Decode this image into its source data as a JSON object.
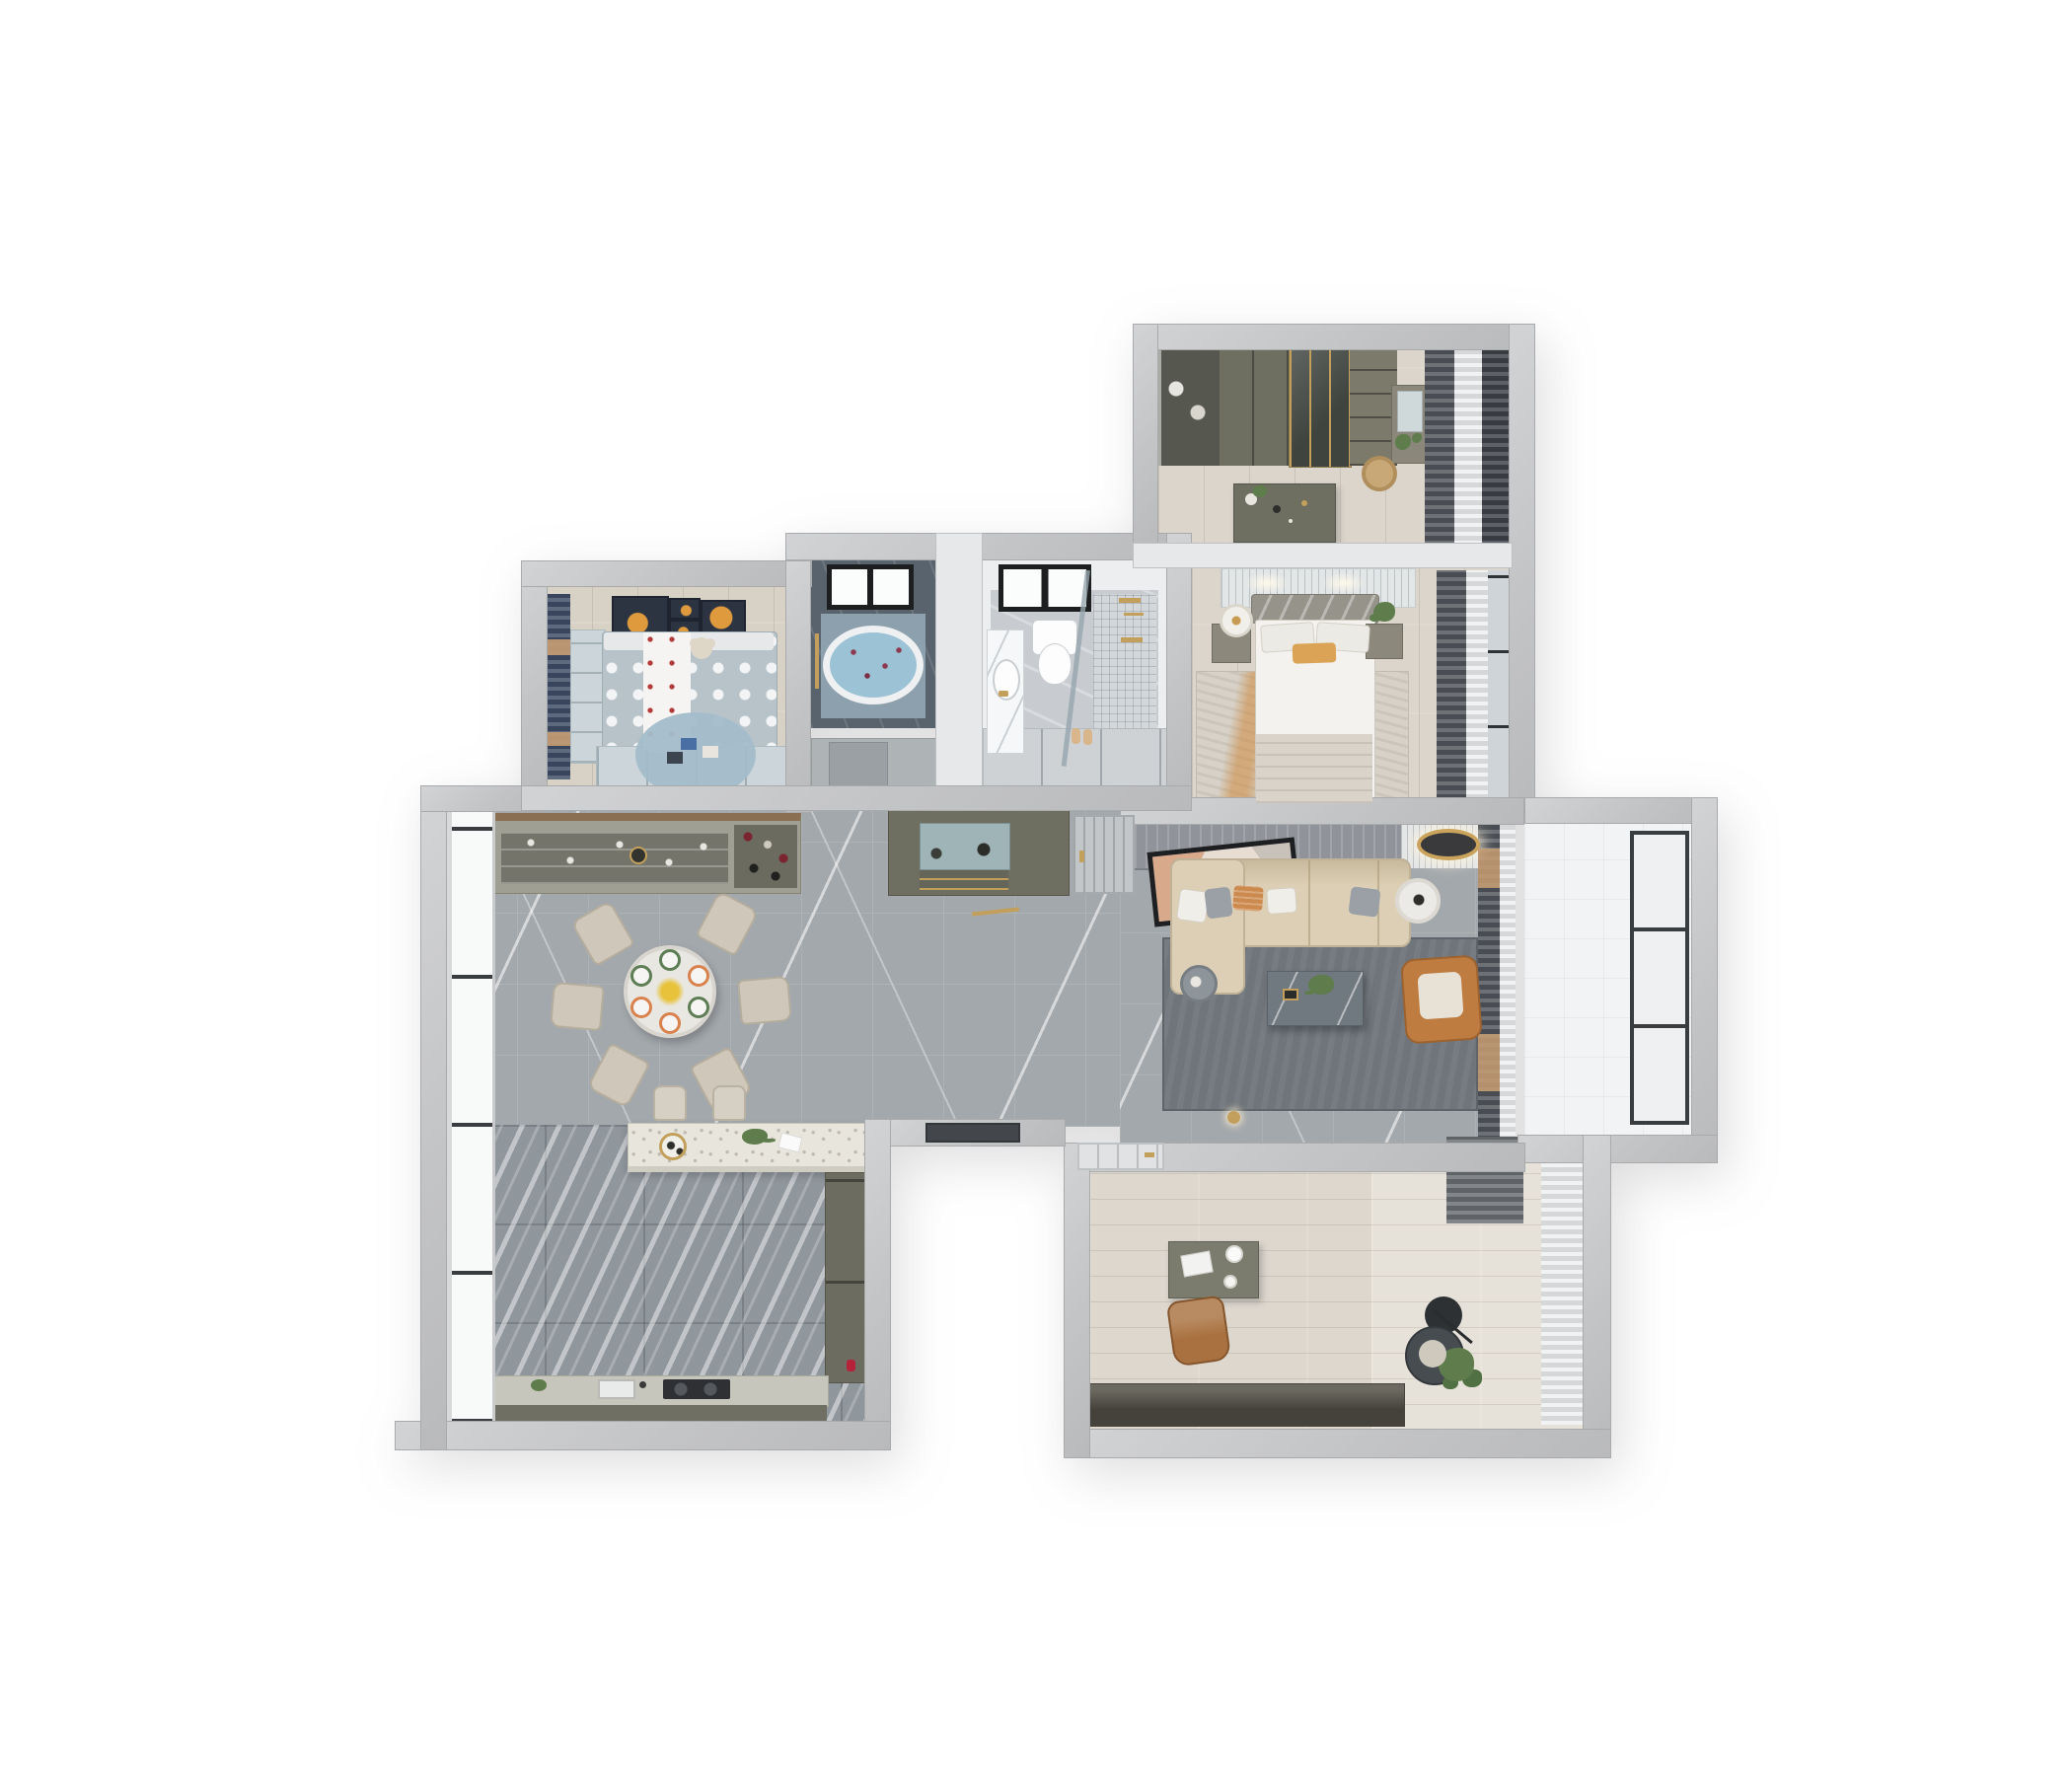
{
  "scene": {
    "type": "3d-floorplan-render",
    "description": "Top-down dollhouse render of a modern apartment on a white background, grey walls cut at top",
    "rooms": [
      {
        "name": "walk-in-closet",
        "position": "top-right",
        "furniture": [
          "wardrobe-hanging",
          "wardrobe-doors",
          "glass-wardrobe",
          "open-shelves",
          "vanity-with-mirror",
          "island-dresser",
          "rattan-basket",
          "window-curtains"
        ]
      },
      {
        "name": "master-bedroom",
        "position": "right",
        "furniture": [
          "ribbed-headboard-wall",
          "double-bed-white",
          "orange-accent-pillow",
          "nightstand-left-with-drum-lamp",
          "nightstand-right-with-plant",
          "distressed-orange-rug",
          "dark-curtains"
        ]
      },
      {
        "name": "bathroom-tub",
        "position": "top-middle",
        "furniture": [
          "black-frame-window",
          "oval-bathtub-with-petals",
          "gold-towel-rail",
          "dark-marble-walls"
        ]
      },
      {
        "name": "bathroom-shower",
        "position": "top-middle-right",
        "furniture": [
          "black-frame-window",
          "wall-hung-toilet",
          "vanity-sink",
          "glass-shower-screen",
          "gold-shower-fixtures",
          "mosaic-floor",
          "slippers"
        ]
      },
      {
        "name": "kids-bedroom",
        "position": "top-left",
        "furniture": [
          "planet-artwork-frames",
          "polka-dot-bed",
          "teddy-bear",
          "navy-curtains",
          "blue-desk-shelf",
          "wardrobe",
          "round-blue-rug"
        ]
      },
      {
        "name": "dining-area",
        "position": "left-center",
        "furniture": [
          "round-marble-table",
          "six-beige-chairs",
          "plates-with-food",
          "yellow-flower-centerpiece",
          "wine-sideboard",
          "floor-to-ceiling-windows"
        ]
      },
      {
        "name": "entry-hall",
        "position": "center",
        "furniture": [
          "shoe-console-cabinet",
          "entry-door",
          "gold-floor-inlay"
        ]
      },
      {
        "name": "living-room",
        "position": "right-center",
        "furniture": [
          "wood-tv-wall",
          "leaning-artwork",
          "cream-sectional-sofa",
          "throw-pillows",
          "marble-coffee-table",
          "orange-leather-armchair",
          "round-side-tables",
          "dark-grey-rug",
          "ceiling-lamp",
          "curtains-with-orange-accents"
        ]
      },
      {
        "name": "balcony",
        "position": "far-right",
        "furniture": [
          "white-tile-floor",
          "full-height-window"
        ]
      },
      {
        "name": "kitchen",
        "position": "bottom-left",
        "furniture": [
          "bar-island-terrazzo-top",
          "two-bar-stools",
          "tall-cabinet",
          "counter-with-sink",
          "cooktop",
          "striped-marble-floor",
          "window-wall"
        ]
      },
      {
        "name": "study",
        "position": "bottom-right",
        "furniture": [
          "white-door",
          "olive-desk",
          "laptop",
          "brown-leather-chair",
          "low-dark-cabinet",
          "black-lounge-chair",
          "arc-floor-lamp",
          "round-black-table",
          "potted-plant",
          "sheer-curtains"
        ]
      }
    ]
  },
  "palette": {
    "background": "#ffffff",
    "wallGrey": "#c5c6c8",
    "wallInner": "#e7e8ea",
    "marble": "#a3a8ac",
    "kitchenFloor": "#8f969c",
    "woodFloor": "#dbd5cb",
    "studyFloor": "#ddd7ce",
    "studyFloorLight": "#e7e2d9",
    "balconyFloor": "#f2f3f4",
    "bathDark": "#59636d",
    "bathTile": "#c8ccd0",
    "tubWater": "#9cc2d5",
    "olive": "#6f6f61",
    "oliveDark": "#565850",
    "sofaCream": "#dccfb5",
    "armchairOrange": "#bf7c40",
    "rugLiving": "#6f757b",
    "rugMaster": "#d7d1c7",
    "rugMasterOrange": "#cd8a3f",
    "kidsDuvet": "#b7c3c9",
    "kidsBlue": "#ccd6da",
    "kidsRug": "#a3bcca",
    "navyCurtain": "#3e4d66",
    "tanAccent": "#c79c72",
    "curtainDark": "#51565c",
    "sheer": "#edeff1",
    "gold": "#c2a05c",
    "frameDark": "#2f3236",
    "plantGreen": "#5f7d4c",
    "bedWhite": "#f4f2ee",
    "chairBeige": "#cfc8ba",
    "deskOlive": "#7c7c6e",
    "chairBrown": "#a9713f"
  }
}
